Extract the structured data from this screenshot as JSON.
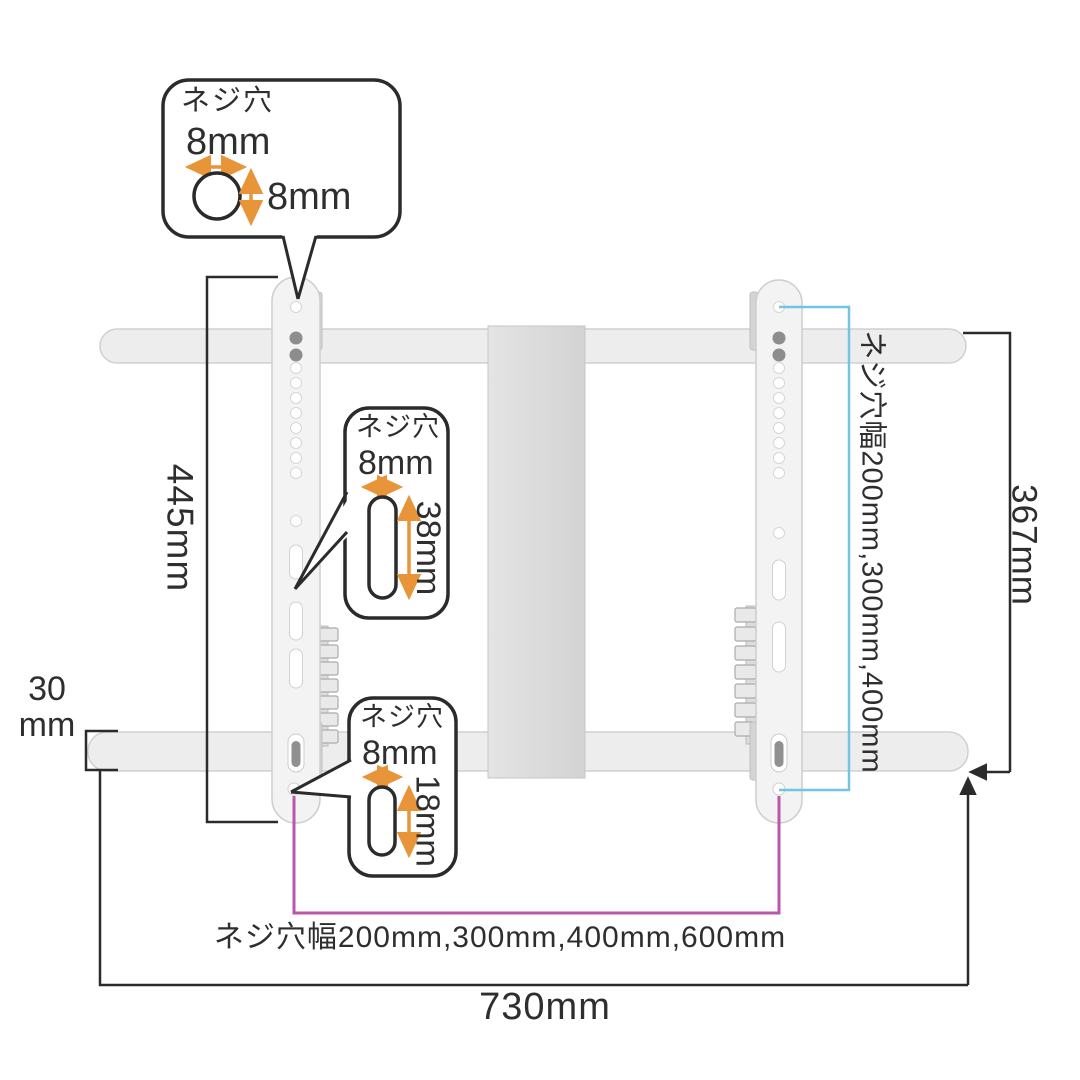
{
  "diagram_title": "tv-wall-mount-dimension-diagram",
  "callouts": {
    "top": {
      "title": "ネジ穴",
      "width_label": "8mm",
      "height_label": "8mm"
    },
    "middle": {
      "title": "ネジ穴",
      "width_label": "8mm",
      "height_label": "38mm"
    },
    "bottom": {
      "title": "ネジ穴",
      "width_label": "8mm",
      "height_label": "18mm"
    }
  },
  "dimensions": {
    "left_bracket_height": "445mm",
    "bar_thickness_value": "30",
    "bar_thickness_unit": "mm",
    "right_bracket_height": "367mm",
    "overall_width": "730mm",
    "screw_hole_width_vertical": "ネジ穴幅200mm,300mm,400mm",
    "screw_hole_width_horizontal": "ネジ穴幅200mm,300mm,400mm,600mm"
  },
  "colors": {
    "line": "#2b2b2b",
    "accent_orange": "#e8953a",
    "accent_magenta": "#ba57aa",
    "accent_blue": "#74c4e1",
    "bar_fill": "#ededed",
    "plate_fill": "#d8d8d8"
  }
}
